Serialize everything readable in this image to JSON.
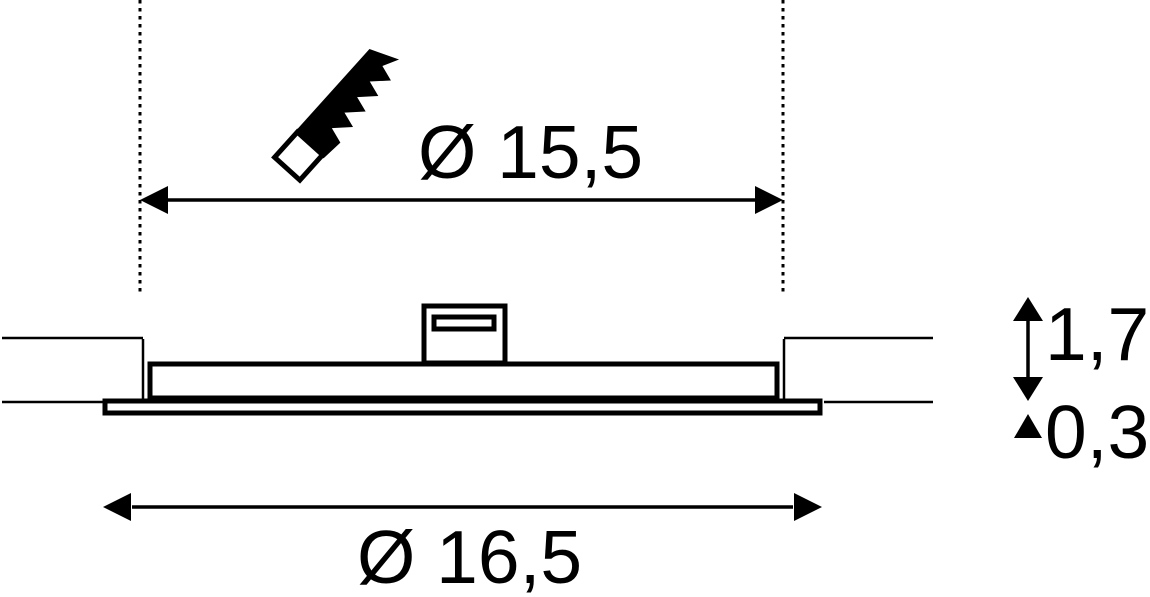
{
  "diagram": {
    "background_color": "#ffffff",
    "line_color": "#000000",
    "cutout_dimension": {
      "label": "Ø 15,5"
    },
    "outer_dimension": {
      "label": "Ø 16,5"
    },
    "recess_depth_dimension": {
      "label": "1,7"
    },
    "flange_thickness_dimension": {
      "label": "0,3"
    },
    "icons": {
      "saw": "saw-icon"
    }
  }
}
